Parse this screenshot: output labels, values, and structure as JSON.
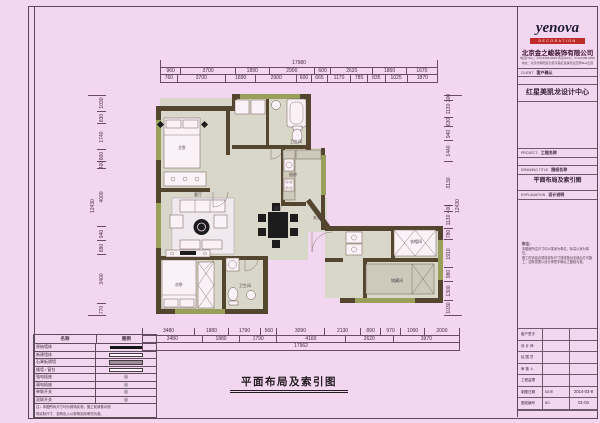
{
  "colors": {
    "background": "#f3d6ef",
    "wall": "#54452f",
    "floor": "#d9d7c9",
    "window_green": "#9aa05c",
    "logo_red": "#bf2b28",
    "dim_text": "#4a2a46"
  },
  "footer_title": "平面布局及索引图",
  "title_block": {
    "logo": "yenova",
    "logo_sub": "DECORATION",
    "company": "北京金之峻装饰有限公司",
    "contact1": "电话(TEL)：010-8488-8848  传真(FAX)：010-8488-8848",
    "contact2": "地址：北京市朝阳区北苑东路红星美凯龙至尊Mall五层",
    "client_row": {
      "label": "CLIENT",
      "value": "客户确认"
    },
    "center": "红星美凯龙设计中心",
    "project": {
      "label": "PROJECT:",
      "value": "工程名称"
    },
    "drawing_title": {
      "label": "DRAWING TITLE",
      "value": "图纸名称"
    },
    "drawing_name": "平面布局及索引图",
    "explanation": {
      "label": "EXPLANATION",
      "value": "设计说明"
    },
    "notes_title": "附注：",
    "notes": [
      "本图纸所注尺寸均以毫米为单位，标高以米为单位。",
      "施工时请结合现场实际尺寸放线核对无误后方可施",
      "工，如有变更以设计师签字确认之图纸为准。"
    ],
    "rows": [
      {
        "label": "客户签字",
        "value": "",
        "extra": ""
      },
      {
        "label": "设 计 师",
        "value": "",
        "extra": ""
      },
      {
        "label": "绘 图 员",
        "value": "",
        "extra": ""
      },
      {
        "label": "审 核 人",
        "value": "",
        "extra": ""
      },
      {
        "label": "工程监理",
        "value": "",
        "extra": ""
      },
      {
        "label": "制图日期",
        "value": "DATE",
        "extra": "2014-03-8"
      },
      {
        "label": "图纸编号",
        "value": "NO.",
        "extra": "01-04"
      }
    ]
  },
  "dims": {
    "top": {
      "overall": "17980",
      "coarse": [
        "960",
        "3700",
        "1890",
        "2900",
        "600",
        "2620",
        "1860",
        "1670"
      ],
      "fine": [
        "760",
        "3700",
        "1890",
        "2900",
        "600",
        "665",
        "1170",
        "785",
        "835",
        "1025",
        "1870"
      ]
    },
    "bottom": {
      "fine": [
        "3480",
        "1880",
        "1790",
        "560",
        "3090",
        "2130",
        "890",
        "970",
        "1000",
        "2000"
      ],
      "grouped": [
        "3480",
        "1880",
        "1790",
        "4160",
        "2620",
        "3970"
      ],
      "overall": "17962"
    },
    "left": {
      "fine": [
        "1030",
        "830",
        "1740",
        "800",
        "400",
        "4000",
        "940",
        "890",
        "3400",
        "770"
      ],
      "overall": "12430"
    },
    "right": {
      "fine": [
        "300",
        "1130",
        "630",
        "940",
        "1440",
        "3130",
        "400",
        "1130",
        "780",
        "1910",
        "980",
        "1300",
        "1030"
      ],
      "overall": "12430"
    }
  },
  "legend": {
    "headers": [
      "名称",
      "图例"
    ],
    "rows": [
      {
        "label": "原始墙体",
        "type": "solid"
      },
      {
        "label": "新建墙体",
        "type": "outline"
      },
      {
        "label": "石膏板隔墙",
        "type": "gray"
      },
      {
        "label": "矮墙 / 窗台",
        "type": "outline"
      },
      {
        "label": "强电插座",
        "type": "circle"
      },
      {
        "label": "弱电插座",
        "type": "circle"
      },
      {
        "label": "单联开关",
        "type": "circle"
      },
      {
        "label": "双联开关",
        "type": "circle"
      }
    ],
    "note_lines": [
      "注：本图所标尺寸均为现场实测，施工前请核对现",
      "场实际尺寸，如有出入以现场实际情况为准。"
    ]
  },
  "plan": {
    "rooms": {
      "master": "主卧",
      "living": "客厅",
      "dining": "餐厅",
      "kitchen": "厨房",
      "bath1": "卫生间",
      "bath2": "卫生间",
      "bed2": "次卧",
      "entry": "玄关",
      "cloak": "衣帽间",
      "storage": "储藏间"
    }
  }
}
